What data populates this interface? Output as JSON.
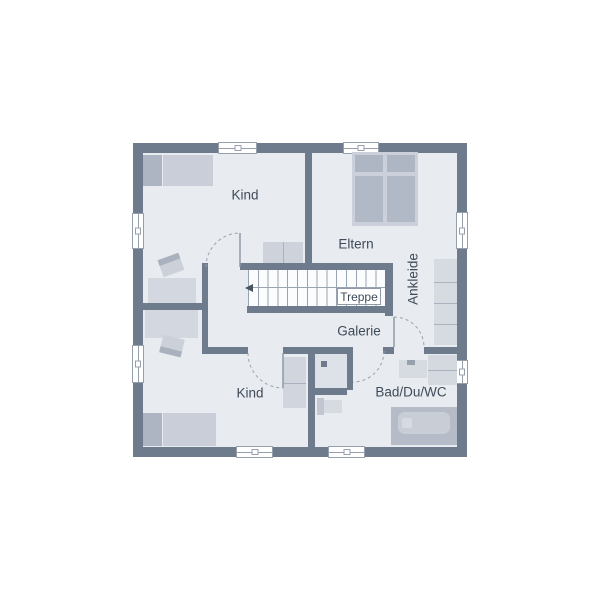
{
  "rooms": {
    "kind_top": "Kind",
    "eltern": "Eltern",
    "ankleide": "Ankleide",
    "galerie": "Galerie",
    "bad_du_wc": "Bad/Du/WC",
    "kind_bottom": "Kind",
    "treppe": "Treppe"
  },
  "colors": {
    "background": "#ffffff",
    "wall": "#6e7b8d",
    "floor": "#e8ebef",
    "furniture_light": "#d3d7df",
    "furniture_medium": "#c9ced8",
    "furniture_dark": "#aeb5c2",
    "window_fill": "#ffffff",
    "window_border": "#96a0ad",
    "door_arc": "#9aa3b0",
    "label_text": "#3f4a59"
  },
  "symbols": [
    "single-bed-icon",
    "double-bed-icon",
    "desk-icon",
    "chair-icon",
    "dresser-icon",
    "wardrobe-icon",
    "bathtub-icon",
    "sink-icon",
    "toilet-icon",
    "shower-icon",
    "stairs-icon",
    "door-swing-icon",
    "window-icon"
  ]
}
